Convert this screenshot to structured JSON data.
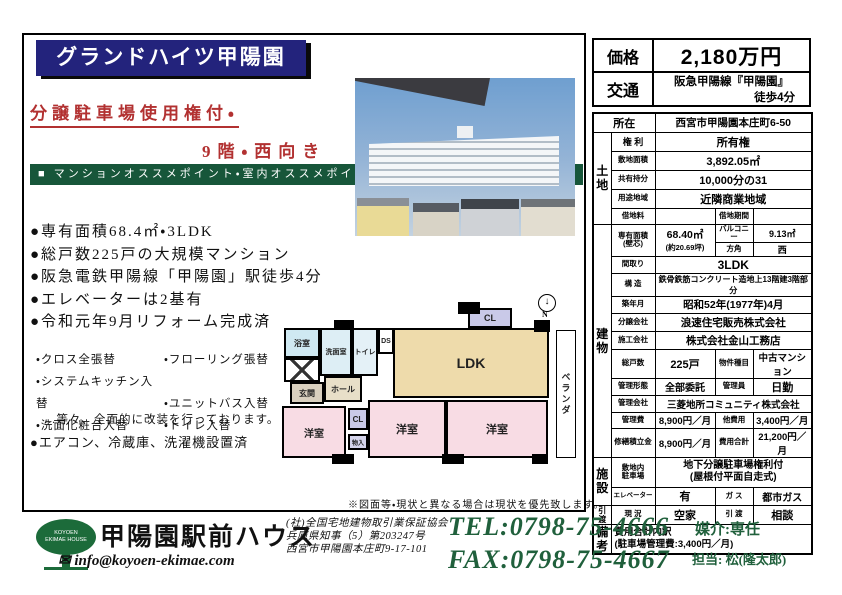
{
  "header": {
    "title": "グランドハイツ甲陽園",
    "catch1": "分譲駐車場使用権付・",
    "catch2": "9階・西向き",
    "banner": "■ マンションオススメポイント・室内オススメポイント"
  },
  "features": {
    "items": [
      "●専有面積68.4㎡・3LDK",
      "●総戸数225戸の大規模マンション",
      "●阪急電鉄甲陽線「甲陽園」駅徒歩4分",
      "●エレベーターは2基有",
      "●令和元年9月リフォーム完成済"
    ]
  },
  "reform": {
    "col1": [
      "・クロス全張替",
      "・システムキッチン入替",
      "・洗面化粧台入替"
    ],
    "col2": [
      "・フローリング張替",
      "・ユニットバス入替",
      "・トイレ入替"
    ],
    "note": "…等々、全面的に改装を行っております。",
    "appliances": "●エアコン、冷蔵庫、洗濯機設置済"
  },
  "floorplan": {
    "bath": "浴室",
    "wash": "洗面室",
    "toilet": "トイレ",
    "ds": "DS",
    "entrance": "玄関",
    "hall": "ホール",
    "cl_top": "CL",
    "cl_low": "CL",
    "storage": "物入",
    "ldk": "LDK",
    "west": "洋室",
    "veranda": "ベランダ",
    "compass_icon": "↓",
    "compass": "N",
    "note": "※図面等・現状と異なる場合は現状を優先致します。"
  },
  "price": {
    "label": "価格",
    "value": "2,180万円"
  },
  "access": {
    "label": "交通",
    "line1": "阪急甲陽線『甲陽園』",
    "line2": "徒歩4分"
  },
  "location": {
    "label": "所在",
    "value": "西宮市甲陽園本庄町6-50"
  },
  "land": {
    "header": "土\n地",
    "rights_label": "権 利",
    "rights_value": "所有権",
    "area_label": "敷地面積",
    "area_value": "3,892.05㎡",
    "share_label": "共有持分",
    "share_value": "10,000分の31",
    "zone_label": "用途地域",
    "zone_value": "近隣商業地域",
    "rent_label": "借地料",
    "rent_value": "",
    "term_label": "借地期間",
    "term_value": ""
  },
  "building": {
    "header": "建\n物",
    "area_label": "専有面積\n(壁芯)",
    "area_value": "68.40㎡",
    "area_sub": "(約20.69坪)",
    "balcony_label": "バルコニー",
    "balcony_value": "9.13㎡",
    "direction_label": "方角",
    "direction_value": "西",
    "layout_label": "間取り",
    "layout_value": "3LDK",
    "structure_label": "構 造",
    "structure_value": "鉄骨鉄筋コンクリート造地上13階建3階部分",
    "built_label": "築年月",
    "built_value": "昭和52年(1977年)4月",
    "developer_label": "分譲会社",
    "developer_value": "浪速住宅販売株式会社",
    "builder_label": "施工会社",
    "builder_value": "株式会社金山工務店",
    "units_label": "総戸数",
    "units_value": "225戸",
    "type_label": "物件種目",
    "type_value": "中古マンション",
    "mgmt_label": "管理形態",
    "mgmt_value": "全部委託",
    "manager_label": "管理員",
    "manager_value": "日勤",
    "mgmtco_label": "管理会社",
    "mgmtco_value": "三菱地所コミュニティ株式会社",
    "fee_label": "管理費",
    "fee_value": "8,900円／月",
    "otherfee_label": "他費用",
    "otherfee_value": "3,400円／月",
    "reserve_label": "修繕積立金",
    "reserve_value": "8,900円／月",
    "total_label": "費用合計",
    "total_value": "21,200円／月"
  },
  "facility": {
    "header": "施\n設",
    "parking_label": "敷地内\n駐車場",
    "parking_value": "地下分譲駐車場権利付\n(屋根付平面自走式)",
    "elevator_label": "エレベーター",
    "elevator_value": "有",
    "gas_label": "ガ ス",
    "gas_value": "都市ガス"
  },
  "handover": {
    "header": "引\n渡",
    "status_label": "現 況",
    "status_value": "空家",
    "delivery_label": "引 渡",
    "delivery_value": "相談"
  },
  "remarks": {
    "header": "備\n考",
    "content": "費用合計内訳\n(駐車場管理費:3,400円／月)"
  },
  "footer": {
    "logo_text": "KOYOEN\nEKIMAE HOUSE",
    "company": "甲陽園駅前ハウス",
    "email_icon": "✉",
    "email": " info@koyoen-ekimae.com",
    "cert1": "(社)全国宅地建物取引業保証協会",
    "cert2": "兵庫県知事（5）第203247号",
    "cert3": "西宮市甲陽園本庄町9-17-101",
    "tel": "TEL:0798-75-4666",
    "fax": "FAX:0798-75-4667",
    "agency": "媒介:専任",
    "staff": "担当: 松(隆太郎)"
  }
}
